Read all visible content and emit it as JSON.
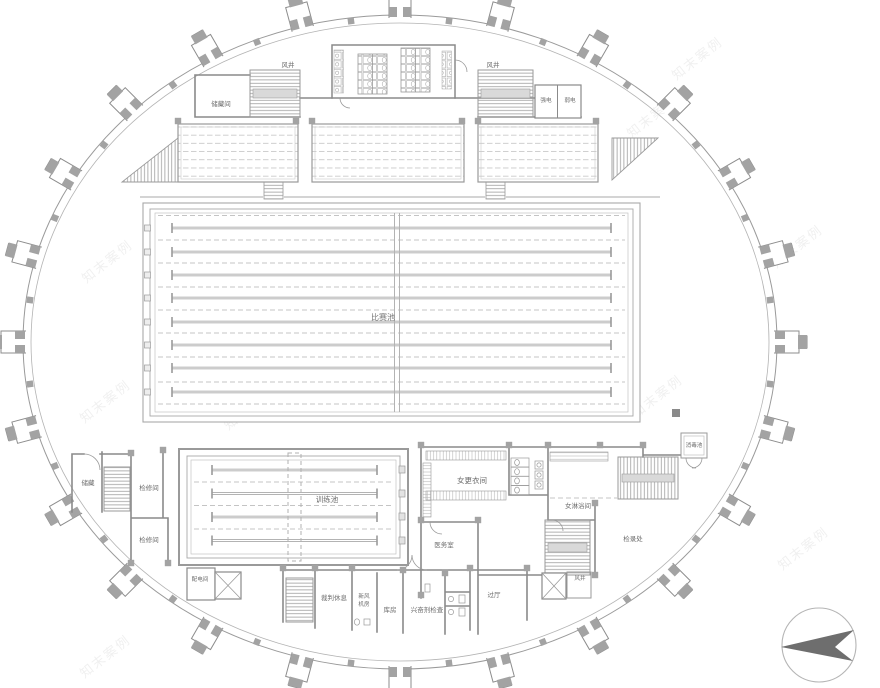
{
  "plan": {
    "pools": {
      "competition": {
        "label": "比赛池",
        "lanes": 8
      },
      "training": {
        "label": "训练池",
        "lanes": 4
      },
      "disinfection": {
        "label": "消毒池"
      }
    },
    "rooms": [
      {
        "name": "vent-shaft-top-left",
        "label": "风井"
      },
      {
        "name": "storage-room-top-left",
        "label": "储藏间"
      },
      {
        "name": "vent-shaft-top-right",
        "label": "风井"
      },
      {
        "name": "strong-electric-closet",
        "label": "强电"
      },
      {
        "name": "weak-electric-closet",
        "label": "弱电"
      },
      {
        "name": "storage-left",
        "label": "储藏"
      },
      {
        "name": "maintenance-room-upper",
        "label": "检修间"
      },
      {
        "name": "maintenance-room-lower",
        "label": "检修间"
      },
      {
        "name": "power-distribution-room",
        "label": "配电间"
      },
      {
        "name": "referee-lounge",
        "label": "裁判休息"
      },
      {
        "name": "fresh-air-plant-room",
        "label": "新风机房",
        "line1": "新风",
        "line2": "机房"
      },
      {
        "name": "storeroom",
        "label": "库房"
      },
      {
        "name": "doping-control-room",
        "label": "兴奋剂检查"
      },
      {
        "name": "vestibule",
        "label": "过厅"
      },
      {
        "name": "vent-shaft-bottom",
        "label": "风井"
      },
      {
        "name": "women-changing-room",
        "label": "女更衣间"
      },
      {
        "name": "women-shower-room",
        "label": "女淋浴间"
      },
      {
        "name": "medical-room",
        "label": "医务室"
      },
      {
        "name": "check-in-office",
        "label": "检录处"
      }
    ],
    "grandstand_sections": 3
  },
  "watermark": {
    "text": "知末案例"
  },
  "compass": {
    "icon": "north-arrow"
  },
  "colors": {
    "wall": "#8a8a8a",
    "column": "#a3a3a3",
    "pool_line": "#9d9d9d",
    "label_text": "#6b6b6b",
    "compass_arrow": "#6e6e6e",
    "background": "#ffffff"
  }
}
